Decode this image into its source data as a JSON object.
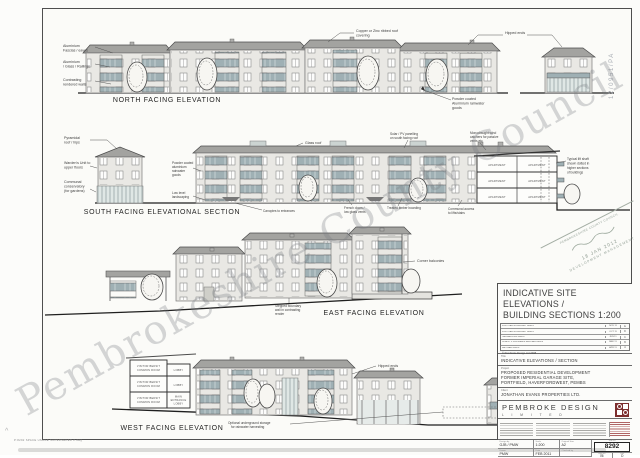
{
  "watermark": "Pembrokeshire County Council",
  "planning_ref": "12/0951/PA",
  "stamp": {
    "council": "PEMBROKESHIRE COUNTY COUNCIL",
    "date": "18 JAN 2012",
    "dept": "DEVELOPMENT MANAGEMENT"
  },
  "footer_note": "P:8292 SPACE USAGE SUPERSEDED 2.dwg",
  "north": {
    "title": "NORTH FACING ELEVATION",
    "labels": {
      "fascias": [
        "Aluminium",
        "Fascias / eaves"
      ],
      "railings": [
        "Aluminium",
        "/ Glass / Railings"
      ],
      "render": [
        "Contrasting",
        "rendered walls"
      ],
      "roof": [
        "Copper or Zinc ribbed roof",
        "covering"
      ],
      "hipped": "Hipped ends",
      "rainwater": [
        "Powder coated",
        "Aluminium rainwater",
        "goods"
      ]
    }
  },
  "south": {
    "title": "SOUTH FACING ELEVATIONAL SECTION",
    "labels": {
      "pyramidal": [
        "Pyramidal",
        "roof / hips"
      ],
      "wardens": [
        "Warden's Unit to",
        "upper floors"
      ],
      "conservatory": [
        "Communal",
        "conservatory",
        "(for gardens)"
      ],
      "rainwater": [
        "Powder coated",
        "aluminium",
        "rainwater",
        "goods"
      ],
      "landscaping": [
        "Low level",
        "landscaping"
      ],
      "glassroof": "Glass roof",
      "solar": [
        "Solar / PV panelling",
        "on south facing roof"
      ],
      "monodraught": [
        "Monodraught wind",
        "catchers for passive",
        "vents etc"
      ],
      "canopies": "Canopies to entrances",
      "french": [
        "French doors /",
        "low glass vents"
      ],
      "timber": "Treated timber boarding",
      "communal": [
        "Communal access",
        "to lifts/stairs"
      ],
      "liftshaft": [
        "Typical lift shaft",
        "shown dotted in",
        "higher sections",
        "of buildings"
      ],
      "apartment": "APARTMENT"
    }
  },
  "east": {
    "title": "EAST FACING ELEVATION",
    "labels": {
      "stepped": [
        "Stepped boundary",
        "wall in contrasting",
        "render"
      ],
      "corner": "Corner balconies"
    }
  },
  "west": {
    "title": "WEST FACING ELEVATION",
    "labels": {
      "hipped": "Hipped ends",
      "storage": [
        "Optional underground storage",
        "for rainwater harvesting"
      ],
      "bedsit": [
        "VISITOR BEDSIT",
        "COMMON ROOM"
      ],
      "lobby": "LOBBY",
      "entrance": [
        "MAIN",
        "ENTRANCE",
        "LOBBY"
      ]
    }
  },
  "titleblock": {
    "heading1": "INDICATIVE SITE ELEVATIONS /",
    "heading2": "BUILDING SECTIONS 1:200",
    "revisions": [
      {
        "note": "FURTHER BOUNDARY AMDS",
        "date": "NOV 11",
        "rev": "E"
      },
      {
        "note": "FURTHER BOUNDARY AMDS",
        "date": "OCT 11",
        "rev": "D"
      },
      {
        "note": "HEDGEROWS AMDS",
        "date": "JUN 11",
        "rev": "C"
      },
      {
        "note": "CLIENT + PLANNERS REVISED AMDS",
        "date": "MAY 11",
        "rev": "B"
      },
      {
        "note": "REVISED AMDS",
        "date": "APR 11",
        "rev": "A"
      }
    ],
    "copyright": "© Pembroke Design Ltd 2008",
    "title_label": "Title",
    "title_value": "INDICATIVE ELEVATIONS / SECTION",
    "project_label": "Project",
    "project_lines": [
      "PROPOSED RESIDENTIAL DEVELOPMENT",
      "FORMER IMPERIAL GARAGE SITE,",
      "PORTFIELD, HAVERFORDWEST, PEMBS"
    ],
    "client_label": "Client",
    "client_value": "JONATHAN EVANS PROPERTIES LTD.",
    "firm_name": "PEMBROKE DESIGN",
    "firm_sub": "L I M I T E D",
    "table": {
      "design_label": "Design by",
      "design": "GJB / PMW",
      "scale_label": "Scale",
      "scale": "1:200",
      "size_label": "Original Size",
      "size": "A2",
      "job_label": "Job No",
      "job": "8292",
      "drawn_label": "Drawn",
      "drawn": "PMW",
      "date_label": "Date",
      "date": "FEB 2011",
      "checked_label": "Checked by",
      "checked": "",
      "dwg_label": "Dwg No",
      "dwg": "06",
      "rev_label": "Rev",
      "rev": "D"
    }
  }
}
